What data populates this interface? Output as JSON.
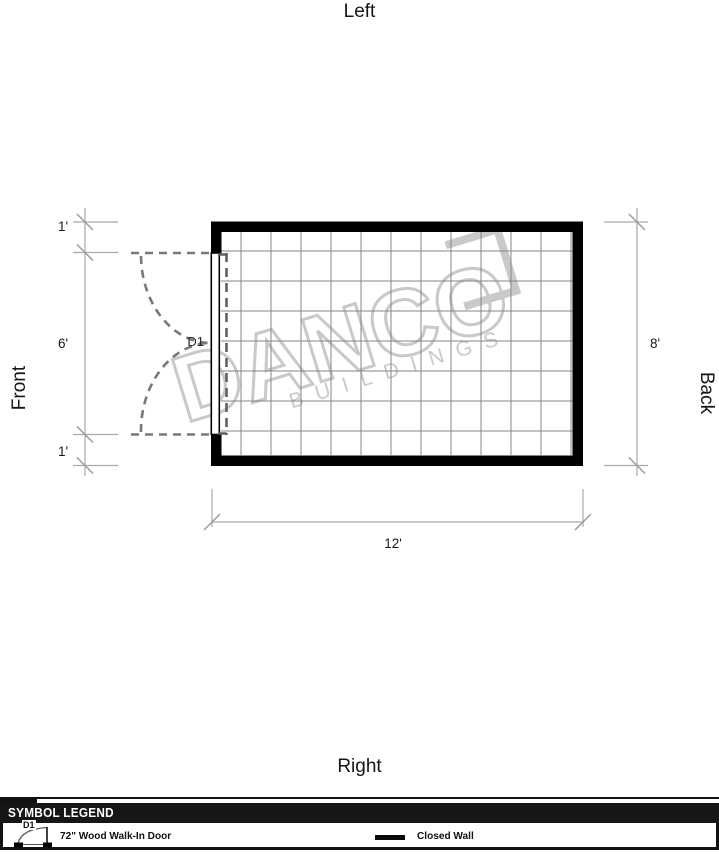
{
  "plan": {
    "orientation": {
      "top": "Left",
      "bottom": "Right",
      "left": "Front",
      "right": "Back"
    },
    "dimensions": {
      "left_top": "1'",
      "left_middle": "6'",
      "left_bottom": "1'",
      "right": "8'",
      "bottom": "12'"
    },
    "door": {
      "label": "D1"
    }
  },
  "watermark": {
    "brand": "DANCO",
    "tagline": "BUILDINGS"
  },
  "legend": {
    "title": "SYMBOL LEGEND",
    "door_item": {
      "symbol": "D1",
      "label": "72\" Wood Walk-In Door"
    },
    "wall_item": {
      "label": "Closed Wall"
    }
  },
  "colors": {
    "wall": "#000000",
    "grid": "#858585",
    "dimension_line": "#a9a9a9",
    "door_dash": "#787878",
    "watermark": "#c9c9c9",
    "legend_header_bg": "#161616",
    "legend_header_text": "#ffffff"
  }
}
